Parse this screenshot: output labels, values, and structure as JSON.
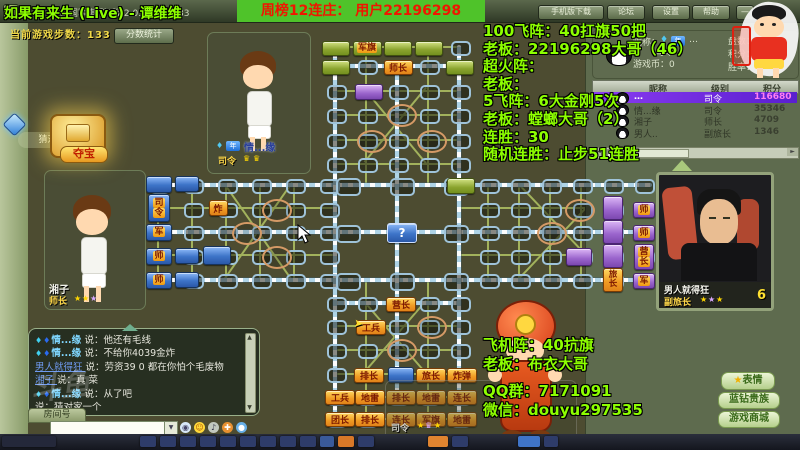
{
  "window": {
    "title": "四国军棋(阵)版 2.0.9 Build033",
    "menu_buttons": [
      "手机版下载",
      "论坛",
      "设置",
      "帮助"
    ],
    "minimize": "—"
  },
  "overlay": {
    "stream_title": "如果有来生 (Live) - 谭维维",
    "banner": "周榜12连庄： 用户22196298",
    "stats_lines": [
      "100飞阵：40扛旗50把",
      "老板：22196298大哥（46）",
      "超火阵：",
      "老板：",
      "5飞阵：6大金刚5次",
      "老板：螳螂大哥（2）",
      "连胜：30",
      "随机连胜：止步51连胜"
    ],
    "promo_lines": [
      "飞机阵：40抗旗",
      "老板：布衣大哥",
      "QQ群：7171091",
      "微信：douyu297535"
    ],
    "watermark": "斗鱼"
  },
  "hud": {
    "steps_label": "当前游戏步数：133",
    "score_button": "分数统计",
    "treasure_button": "夺宝",
    "treasure_tooltip": "猜对家一个"
  },
  "players": {
    "left": {
      "name": "湘子",
      "rank": "师长"
    },
    "top": {
      "name": "情...缘",
      "rank": "司令",
      "badge": "年"
    },
    "right": {
      "name": "男人就得狂",
      "rank": "副旅长",
      "coin": "6"
    },
    "bottom": {
      "rank": "司令"
    }
  },
  "profile": {
    "nickname_label": "昵称：",
    "nickname_value": "…",
    "year_badge": "年",
    "rank": "司令",
    "coins_label": "游戏币：0",
    "stat_labels": [
      "盘数：",
      "积分：",
      "胜率："
    ],
    "table": {
      "headers": [
        "昵称",
        "级别",
        "积分"
      ],
      "rows": [
        {
          "name": "…",
          "rank": "司令",
          "score": "116680",
          "highlight": true
        },
        {
          "name": "情...缘",
          "rank": "司令",
          "score": "35346",
          "highlight": false
        },
        {
          "name": "湘子",
          "rank": "师长",
          "score": "4709",
          "highlight": false
        },
        {
          "name": "男人..",
          "rank": "副旅长",
          "score": "1346",
          "highlight": false
        }
      ]
    }
  },
  "chat": {
    "messages": [
      {
        "name": "情...缘",
        "style": "vip",
        "text": "说：他还有毛线"
      },
      {
        "name": "情...缘",
        "style": "vip",
        "text": "说：不给你4039金炸"
      },
      {
        "name": "男人就得狂",
        "style": "link",
        "text": "说：劳资39 0 都在你怕个毛废物"
      },
      {
        "name": "湘子",
        "style": "link",
        "text": "说：真 菜"
      },
      {
        "name": "情...缘",
        "style": "vip",
        "text": "说：从了吧"
      },
      {
        "name": "",
        "style": "hidden",
        "text": "说：猜对家一个"
      }
    ],
    "room_tab": "房间号",
    "input_value": ""
  },
  "side_buttons": [
    "表情",
    "蓝钻贵族",
    "游戏商城"
  ],
  "board": {
    "unknown_piece": "?",
    "pieces": [
      {
        "x": 158,
        "y": 183,
        "w": 24,
        "h": 15,
        "c": "blue",
        "t": ""
      },
      {
        "x": 158,
        "y": 207,
        "w": 20,
        "h": 26,
        "c": "blue",
        "t": "司令",
        "v": true
      },
      {
        "x": 158,
        "y": 231,
        "w": 24,
        "h": 15,
        "c": "blue",
        "t": "军"
      },
      {
        "x": 158,
        "y": 255,
        "w": 24,
        "h": 15,
        "c": "blue",
        "t": "师"
      },
      {
        "x": 158,
        "y": 279,
        "w": 24,
        "h": 15,
        "c": "blue",
        "t": "师"
      },
      {
        "x": 186,
        "y": 183,
        "w": 22,
        "h": 14,
        "c": "blue",
        "t": ""
      },
      {
        "x": 186,
        "y": 255,
        "w": 22,
        "h": 14,
        "c": "blue",
        "t": ""
      },
      {
        "x": 186,
        "y": 279,
        "w": 22,
        "h": 14,
        "c": "blue",
        "t": ""
      },
      {
        "x": 217,
        "y": 207,
        "w": 17,
        "h": 14,
        "c": "orange",
        "t": "炸"
      },
      {
        "x": 216,
        "y": 254,
        "w": 26,
        "h": 17,
        "c": "blue",
        "t": ""
      },
      {
        "x": 401,
        "y": 232,
        "w": 28,
        "h": 18,
        "c": "blue",
        "t": "?",
        "q": true
      },
      {
        "x": 335,
        "y": 47,
        "w": 26,
        "h": 13,
        "c": "green",
        "t": ""
      },
      {
        "x": 366,
        "y": 47,
        "w": 27,
        "h": 13,
        "c": "green",
        "t": "军旗"
      },
      {
        "x": 397,
        "y": 47,
        "w": 26,
        "h": 13,
        "c": "green",
        "t": ""
      },
      {
        "x": 428,
        "y": 47,
        "w": 26,
        "h": 13,
        "c": "green",
        "t": ""
      },
      {
        "x": 335,
        "y": 66,
        "w": 26,
        "h": 13,
        "c": "green",
        "t": ""
      },
      {
        "x": 397,
        "y": 66,
        "w": 27,
        "h": 13,
        "c": "orange",
        "t": "师长"
      },
      {
        "x": 459,
        "y": 66,
        "w": 26,
        "h": 13,
        "c": "green",
        "t": ""
      },
      {
        "x": 368,
        "y": 91,
        "w": 26,
        "h": 14,
        "c": "purple",
        "t": ""
      },
      {
        "x": 460,
        "y": 185,
        "w": 26,
        "h": 14,
        "c": "green",
        "t": ""
      },
      {
        "x": 612,
        "y": 207,
        "w": 18,
        "h": 22,
        "c": "purple",
        "t": ""
      },
      {
        "x": 612,
        "y": 231,
        "w": 18,
        "h": 22,
        "c": "purple",
        "t": ""
      },
      {
        "x": 612,
        "y": 255,
        "w": 18,
        "h": 22,
        "c": "purple",
        "t": ""
      },
      {
        "x": 612,
        "y": 279,
        "w": 18,
        "h": 22,
        "c": "orange",
        "t": "旅长",
        "v": true
      },
      {
        "x": 643,
        "y": 209,
        "w": 20,
        "h": 14,
        "c": "purple",
        "t": "师"
      },
      {
        "x": 643,
        "y": 232,
        "w": 20,
        "h": 14,
        "c": "purple",
        "t": "师"
      },
      {
        "x": 643,
        "y": 256,
        "w": 18,
        "h": 24,
        "c": "purple",
        "t": "营长",
        "v": true
      },
      {
        "x": 643,
        "y": 280,
        "w": 20,
        "h": 14,
        "c": "purple",
        "t": "军"
      },
      {
        "x": 578,
        "y": 256,
        "w": 24,
        "h": 16,
        "c": "purple",
        "t": ""
      },
      {
        "x": 400,
        "y": 303,
        "w": 28,
        "h": 13,
        "c": "orange",
        "t": "营长"
      },
      {
        "x": 370,
        "y": 326,
        "w": 28,
        "h": 13,
        "c": "orange",
        "t": "工兵"
      },
      {
        "x": 368,
        "y": 374,
        "w": 28,
        "h": 13,
        "c": "orange",
        "t": "排长"
      },
      {
        "x": 400,
        "y": 374,
        "w": 24,
        "h": 14,
        "c": "blue",
        "t": ""
      },
      {
        "x": 430,
        "y": 374,
        "w": 28,
        "h": 13,
        "c": "orange",
        "t": "旅长"
      },
      {
        "x": 461,
        "y": 374,
        "w": 28,
        "h": 13,
        "c": "orange",
        "t": "炸弹"
      },
      {
        "x": 339,
        "y": 396,
        "w": 28,
        "h": 13,
        "c": "orange",
        "t": "工兵"
      },
      {
        "x": 369,
        "y": 396,
        "w": 28,
        "h": 13,
        "c": "orange",
        "t": "地雷"
      },
      {
        "x": 400,
        "y": 396,
        "w": 28,
        "h": 13,
        "c": "orange",
        "t": "排长"
      },
      {
        "x": 430,
        "y": 396,
        "w": 28,
        "h": 13,
        "c": "orange",
        "t": "地雷"
      },
      {
        "x": 461,
        "y": 396,
        "w": 28,
        "h": 13,
        "c": "orange",
        "t": "连长"
      },
      {
        "x": 339,
        "y": 418,
        "w": 28,
        "h": 13,
        "c": "orange",
        "t": "团长"
      },
      {
        "x": 369,
        "y": 418,
        "w": 28,
        "h": 13,
        "c": "orange",
        "t": "排长"
      },
      {
        "x": 400,
        "y": 418,
        "w": 28,
        "h": 13,
        "c": "orange",
        "t": "连长"
      },
      {
        "x": 430,
        "y": 418,
        "w": 28,
        "h": 13,
        "c": "orange",
        "t": "军旗"
      },
      {
        "x": 461,
        "y": 418,
        "w": 28,
        "h": 13,
        "c": "orange",
        "t": "地雷"
      }
    ],
    "camps": [
      [
        275,
        209
      ],
      [
        245,
        232
      ],
      [
        275,
        256
      ],
      [
        400,
        114
      ],
      [
        370,
        140
      ],
      [
        430,
        140
      ],
      [
        578,
        209
      ],
      [
        550,
        232
      ],
      [
        430,
        326
      ],
      [
        400,
        349
      ]
    ]
  },
  "colors": {
    "overlay_lime": "#8dff00",
    "banner_bg": "#4fc32a",
    "banner_text": "#f01600",
    "board_bg": "#4d4c31",
    "blue_piece": "#3d74c8",
    "green_piece": "#8aa32e",
    "purple_piece": "#9a64cc",
    "orange_piece": "#f09a22",
    "highlight_row": "#7a2fe0",
    "highlight_score": "#ff7df2"
  }
}
